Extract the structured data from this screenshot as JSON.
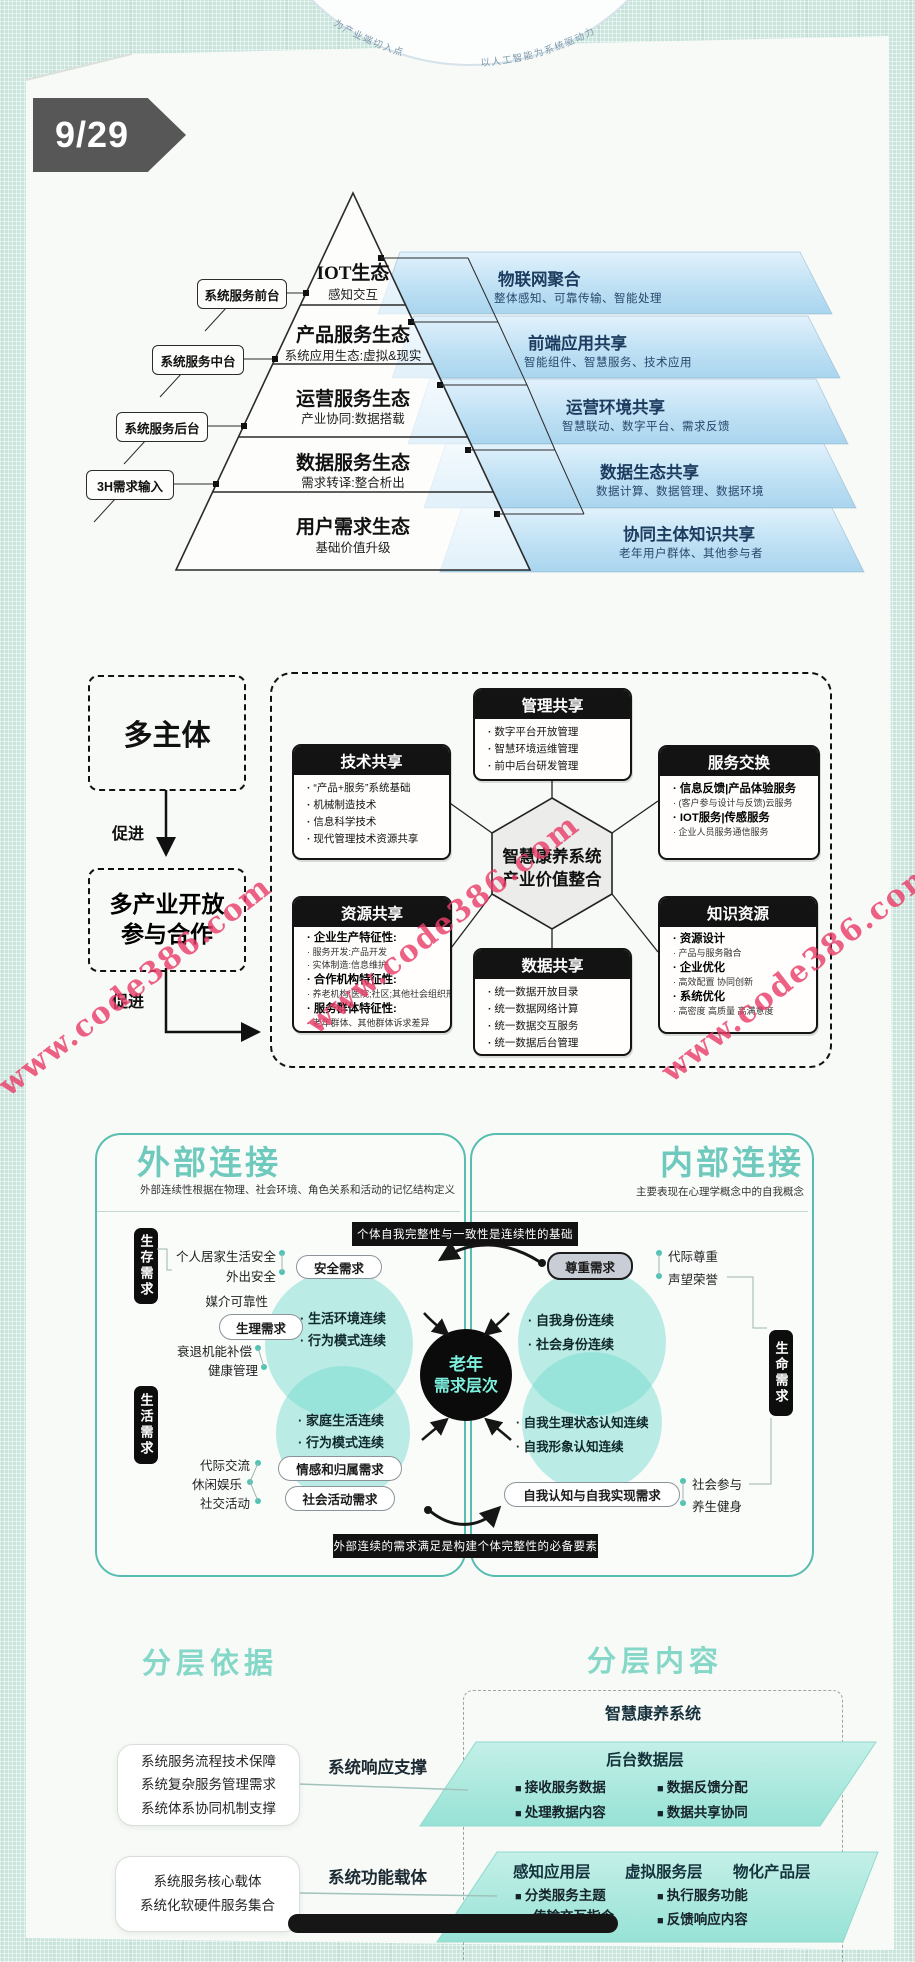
{
  "colors": {
    "teal_accent": "#56bdb0",
    "banner_text": "#1c3c60",
    "watermark_red": "#e93e6a",
    "badge_bg": "#575757",
    "section_title_teal": "#85d7c8"
  },
  "page": {
    "badge": "9/29",
    "arc_left": "为产业端切入点",
    "arc_right": "以人工智能为系统驱动力",
    "watermark": "www.code386.com"
  },
  "pyramid": {
    "layers": [
      {
        "title": "IOT生态",
        "subtitle": "感知交互"
      },
      {
        "title": "产品服务生态",
        "subtitle": "系统应用生态:虚拟&现实"
      },
      {
        "title": "运营服务生态",
        "subtitle": "产业协同:数据搭载"
      },
      {
        "title": "数据服务生态",
        "subtitle": "需求转译:整合析出"
      },
      {
        "title": "用户需求生态",
        "subtitle": "基础价值升级"
      }
    ],
    "side_labels": [
      "系统服务前台",
      "系统服务中台",
      "系统服务后台",
      "3H需求输入"
    ],
    "banners": [
      {
        "title": "物联网聚合",
        "subtitle": "整体感知、可靠传输、智能处理"
      },
      {
        "title": "前端应用共享",
        "subtitle": "智能组件、智慧服务、技术应用"
      },
      {
        "title": "运营环境共享",
        "subtitle": "智慧联动、数字平台、需求反馈"
      },
      {
        "title": "数据生态共享",
        "subtitle": "数据计算、数据管理、数据环境"
      },
      {
        "title": "协同主体知识共享",
        "subtitle": "老年用户群体、其他参与者"
      }
    ]
  },
  "eco": {
    "multi_subject": "多主体",
    "promote1": "促进",
    "coop1": "多产业开放",
    "coop2": "参与合作",
    "promote2": "促进",
    "hex1": "智慧康养系统",
    "hex2": "产业价值整合",
    "manage": {
      "title": "管理共享",
      "items": [
        "数字平台开放管理",
        "智慧环境运维管理",
        "前中后台研发管理"
      ]
    },
    "tech": {
      "title": "技术共享",
      "items": [
        "“产品+服务”系统基础",
        "机械制造技术",
        "信息科学技术",
        "现代管理技术资源共享"
      ]
    },
    "service": {
      "title": "服务交换",
      "strong1": "信息反馈|产品体验服务",
      "small1": "(客户参与设计与反馈)云服务",
      "strong2": "IOT服务|传感服务",
      "small2": "企业人员服务通信服务"
    },
    "resource": {
      "title": "资源共享",
      "h1": "企业生产特征性:",
      "s1": "服务开发:产品开发",
      "s2": "实体制造:信息维护",
      "h2": "合作机构特征性:",
      "s3": "养老机构:医院;社区;其他社会组织形式",
      "h3": "服务群体特征性:",
      "s4": "老年群体、其他群体诉求差异"
    },
    "knowledge": {
      "title": "知识资源",
      "h1": "资源设计",
      "s1": "产品与服务融合",
      "h2": "企业优化",
      "s2": "高效配置 协同创新",
      "h3": "系统优化",
      "s3": "高密度 高质量 高满意度"
    },
    "data": {
      "title": "数据共享",
      "items": [
        "统一数据开放目录",
        "统一数据网络计算",
        "统一数据交互服务",
        "统一数据后台管理"
      ]
    }
  },
  "needs": {
    "external": {
      "title": "外部连接",
      "subtitle": "外部连续性根据在物理、社会环境、角色关系和活动的记忆结构定义"
    },
    "internal": {
      "title": "内部连接",
      "subtitle": "主要表现在心理学概念中的自我概念"
    },
    "banner_top": "个体自我完整性与一致性是连续性的基础",
    "banner_bottom": "外部连续的需求满足是构建个体完整性的必备要素",
    "circle1": "老年",
    "circle2": "需求层次",
    "pills": {
      "survival": "生存需求",
      "life": "生活需求",
      "vitality": "生命需求",
      "safety": "安全需求",
      "physio": "生理需求",
      "emotion": "情感和归属需求",
      "social": "社会活动需求",
      "esteem": "尊重需求",
      "selfreal": "自我认知与自我实现需求"
    },
    "left_items": {
      "home": "个人居家生活安全",
      "out": "外出安全",
      "media": "媒介可靠性",
      "decline": "衰退机能补偿",
      "health": "健康管理",
      "inter": "代际交流",
      "leisure": "休闲娱乐",
      "activity": "社交活动"
    },
    "right_items": {
      "respect": "代际尊重",
      "honor": "声望荣誉",
      "participate": "社会参与",
      "fitness": "养生健身"
    },
    "venn": {
      "c1a": "生活环境连续",
      "c1b": "行为模式连续",
      "c2a": "家庭生活连续",
      "c2b": "行为模式连续",
      "c3a": "自我身份连续",
      "c3b": "社会身份连续",
      "c4a": "自我生理状态认知连续",
      "c4b": "自我形象认知连续"
    }
  },
  "sec": {
    "left_title": "分层依据",
    "right_title": "分层内容",
    "sys": "智慧康养系统",
    "p1": {
      "title": "后台数据层",
      "i1": "接收服务数据",
      "i2": "数据反馈分配",
      "i3": "处理教据内容",
      "i4": "数据共享协同"
    },
    "p2": {
      "h1": "感知应用层",
      "h2": "虚拟服务层",
      "h3": "物化产品层",
      "i1": "分类服务主题",
      "i2": "执行服务功能",
      "i3": "传输交互指令",
      "i4": "反馈响应内容"
    },
    "boxA": {
      "l1": "系统服务流程技术保障",
      "l2": "系统复杂服务管理需求",
      "l3": "系统体系协同机制支撑"
    },
    "labelA": "系统响应支撑",
    "boxB": {
      "l1": "系统服务核心载体",
      "l2": "系统化软硬件服务集合"
    },
    "labelB": "系统功能载体"
  }
}
